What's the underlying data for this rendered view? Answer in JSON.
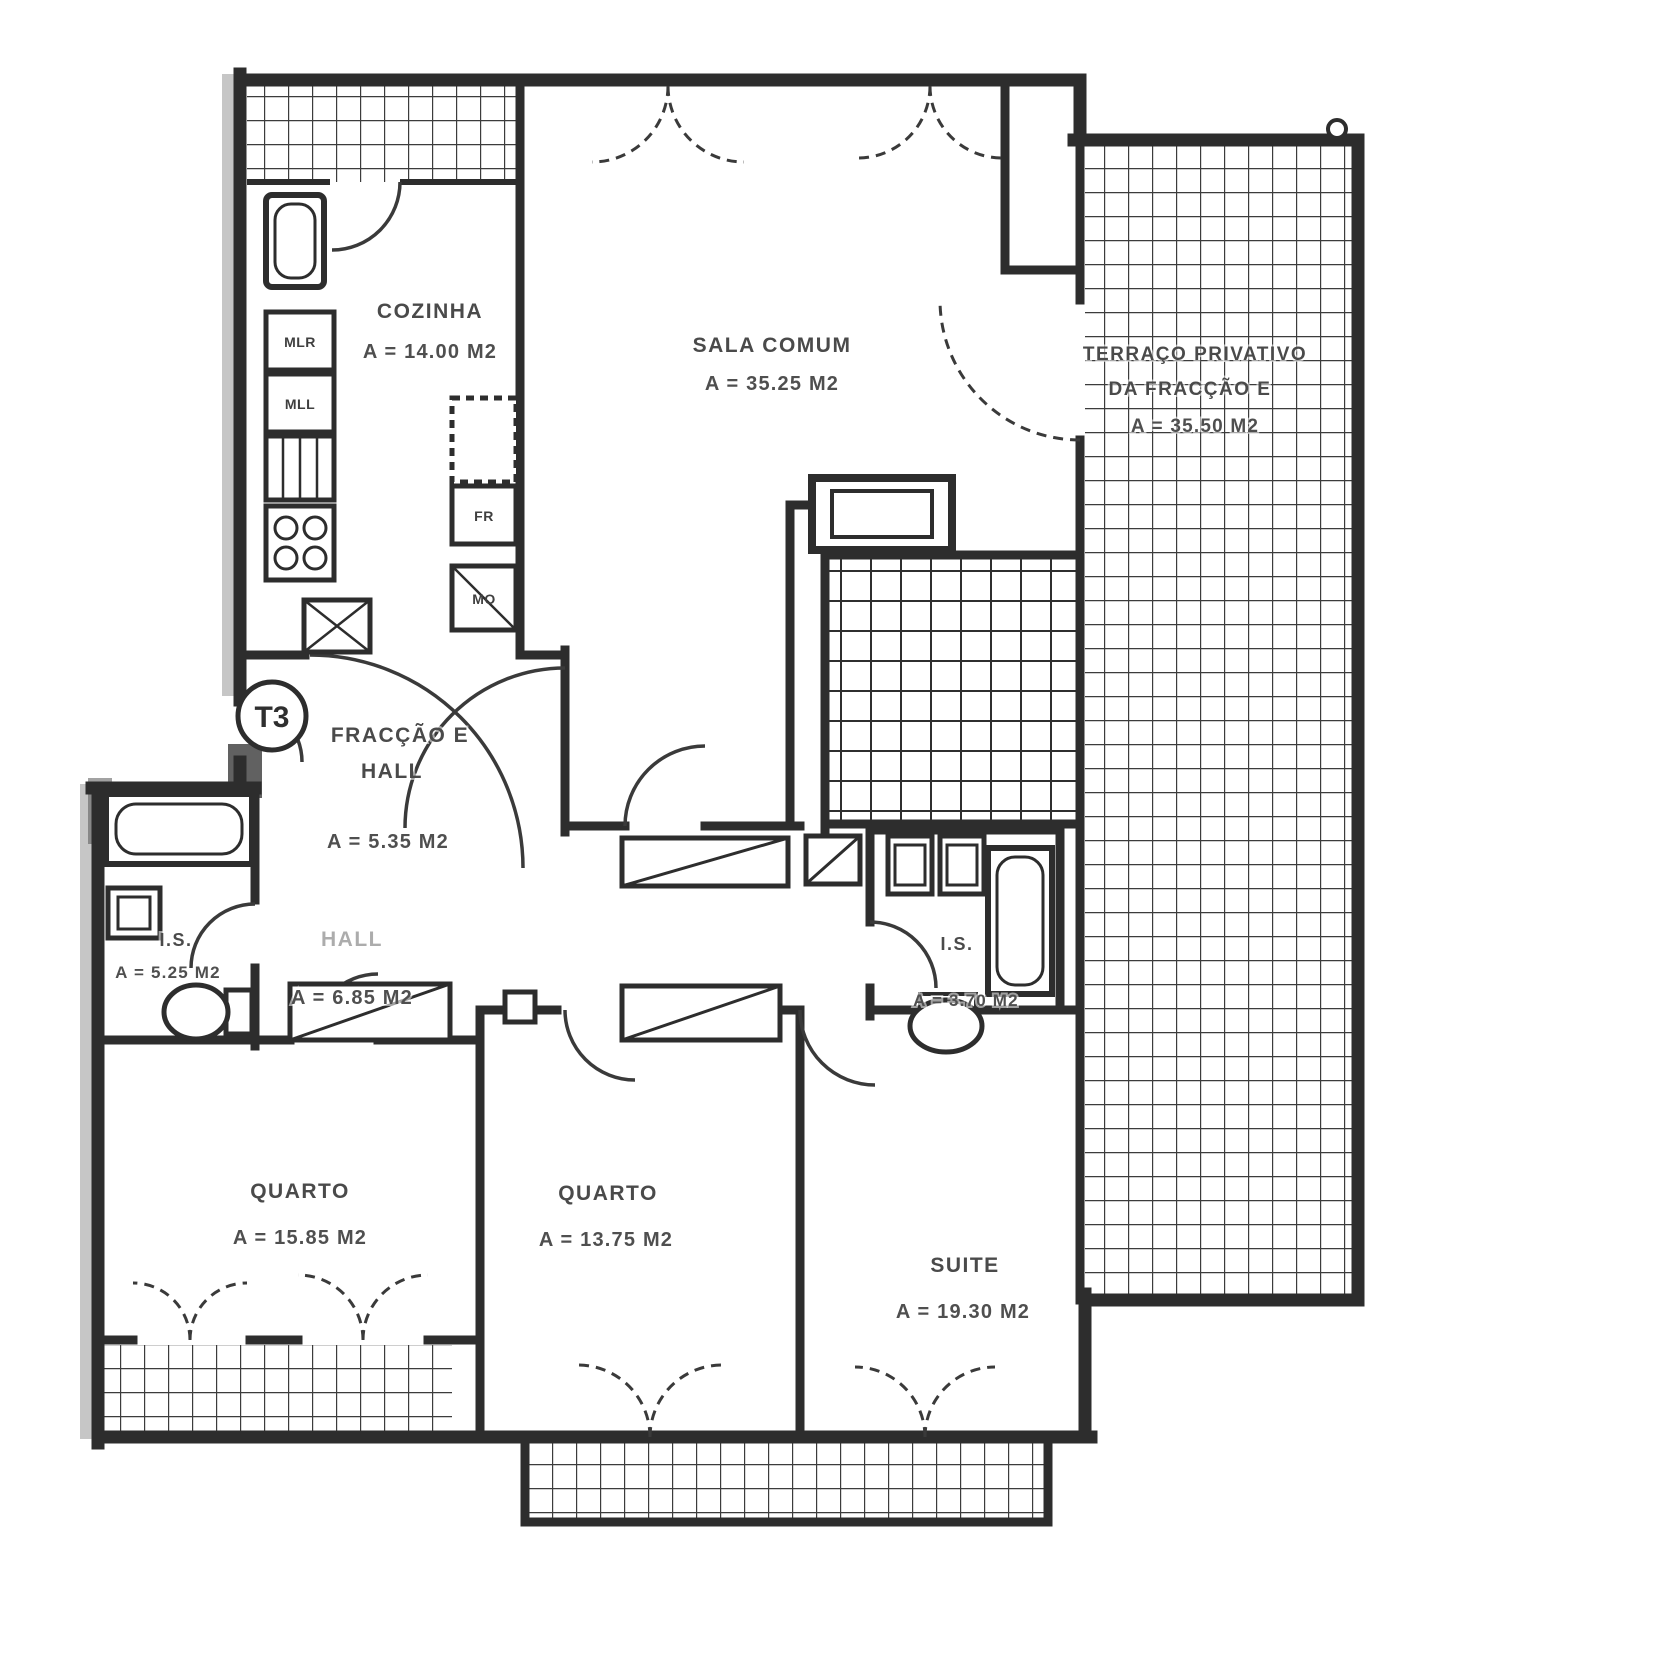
{
  "plan": {
    "unit_badge": "T3",
    "rooms": {
      "cozinha": {
        "name": "COZINHA",
        "area": "A = 14.00 M2"
      },
      "sala": {
        "name": "SALA COMUM",
        "area": "A = 35.25 M2"
      },
      "terraco": {
        "line1": "TERRAÇO PRIVATIVO",
        "line2": "DA FRACÇÃO E",
        "area": "A = 35.50 M2"
      },
      "hall_entrada": {
        "line1": "FRACÇÃO E",
        "line2": "HALL",
        "area": "A = 5.35 M2"
      },
      "hall_interior": {
        "name": "HALL",
        "area": "A = 6.85 M2"
      },
      "is_esquerda": {
        "name": "I.S.",
        "area": "A = 5.25 M2"
      },
      "is_suite": {
        "name": "I.S.",
        "area": "A = 3.70 M2"
      },
      "quarto_1": {
        "name": "QUARTO",
        "area": "A = 15.85 M2"
      },
      "quarto_2": {
        "name": "QUARTO",
        "area": "A = 13.75 M2"
      },
      "suite": {
        "name": "SUITE",
        "area": "A = 19.30 M2"
      }
    },
    "appliances": {
      "mlr": "MLR",
      "mll": "MLL",
      "fr": "FR",
      "mo": "MO"
    },
    "colors": {
      "ink": "#2d2d2d",
      "paper": "#ffffff",
      "tile_line": "#3c3c3c",
      "text": "#4a4a4a"
    }
  }
}
